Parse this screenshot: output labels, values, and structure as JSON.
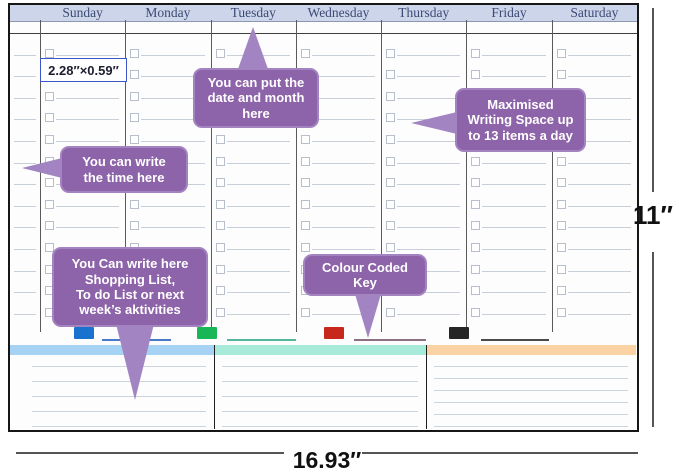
{
  "header": {
    "days": [
      "Sunday",
      "Monday",
      "Tuesday",
      "Wednesday",
      "Thursday",
      "Friday",
      "Saturday"
    ]
  },
  "planner": {
    "rows_per_day": 13,
    "cell_size_label": "2.28″×0.59″",
    "header_band_color": "#cdd5ea",
    "callout_color": "#8d63a9"
  },
  "callouts": {
    "date_month": "You can put the\ndate and month\nhere",
    "max_space": "Maximised\nWriting Space up\nto 13 items a day",
    "time": "You can write\nthe time here",
    "shopping": "You Can write here\nShopping List,\nTo do List or next\nweek’s aktivities",
    "colour_key": "Colour Coded\nKey"
  },
  "key": {
    "items": [
      {
        "name": "blue",
        "swatch": "#1a72cf",
        "line": "#4a78c8"
      },
      {
        "name": "green",
        "swatch": "#17b757",
        "line": "#53b89b"
      },
      {
        "name": "red",
        "swatch": "#c8281c",
        "line": "#8d7080"
      },
      {
        "name": "black",
        "swatch": "#262626",
        "line": "#4a4a4a"
      }
    ]
  },
  "notes": {
    "panels": [
      {
        "strip": "#a6d2f4"
      },
      {
        "strip": "#a8ead9"
      },
      {
        "strip": "#fad2a4"
      }
    ],
    "lines_per_panel": [
      5,
      5,
      6
    ]
  },
  "dimensions": {
    "height_label": "11″",
    "width_label": "16.93″"
  }
}
